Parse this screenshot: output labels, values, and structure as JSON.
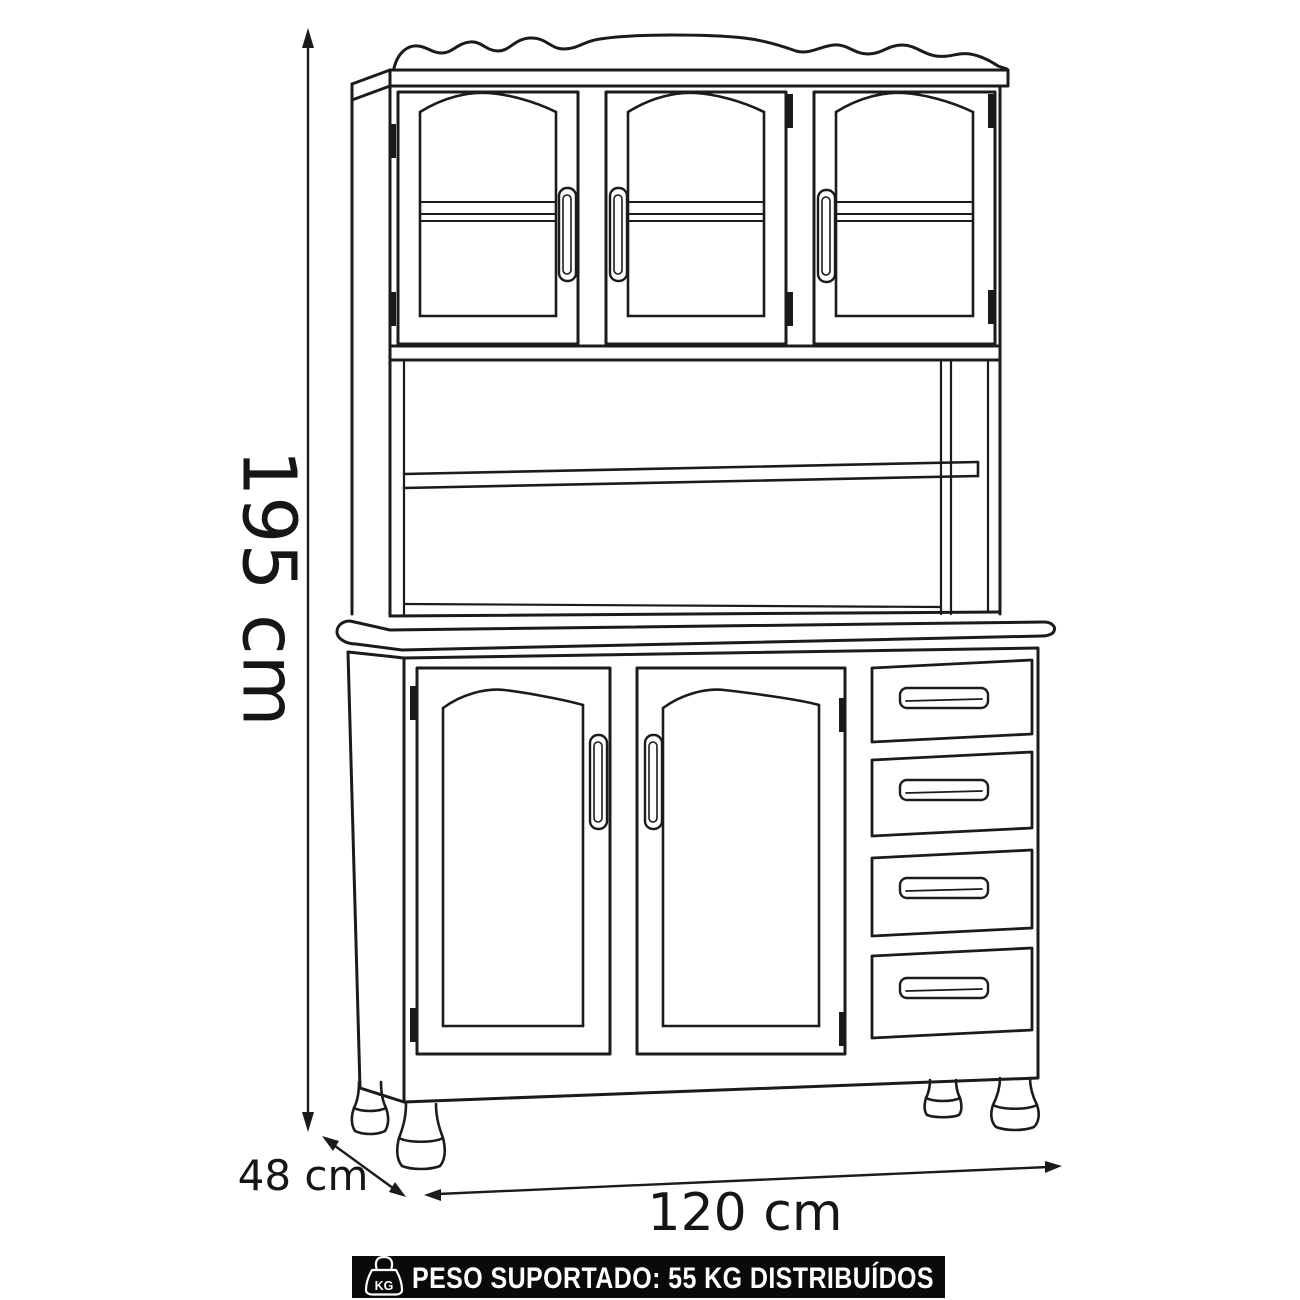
{
  "scene": {
    "background": "#ffffff",
    "line_color": "#1b1b1b",
    "subject": "kitchen-hutch-cabinet-line-drawing"
  },
  "dimensions": {
    "height": "195 cm",
    "depth": "48 cm",
    "width": "120 cm"
  },
  "banner": {
    "text": "PESO SUPORTADO: 55 KG DISTRIBUÍDOS",
    "icon": "weight-kg-icon",
    "icon_text": "KG",
    "background": "#0a0a0a",
    "text_color": "#ffffff"
  }
}
